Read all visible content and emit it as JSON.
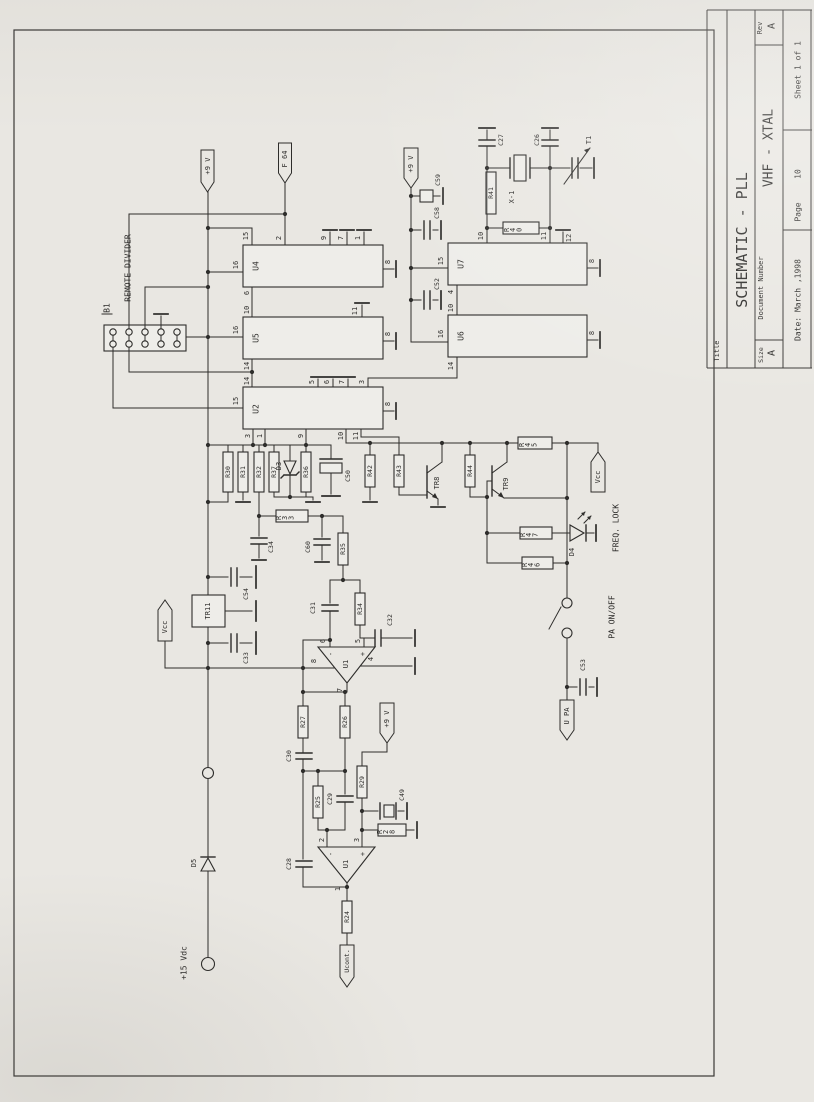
{
  "title_block": {
    "title_label": "Title",
    "title": "SCHEMATIC - PLL",
    "size_label": "Size",
    "size": "A",
    "document_number_label": "Document Number",
    "document_number": "VHF - XTAL",
    "rev_label": "Rev",
    "rev": "A",
    "date": "Date: March ,1998",
    "page_label": "Page",
    "page": "10",
    "sheet": "Sheet 1 of 1"
  },
  "annotations": {
    "b1": "B1",
    "remote_divider": "REMOTE DIVIDER",
    "pa_on_off": "PA ON/OFF",
    "freq_lock": "FREQ. LOCK",
    "plus15": "+15 Vdc"
  },
  "flags": {
    "v9_top": "+9 V",
    "v9_right": "+9 V",
    "v9_mid": "+9 V",
    "f64": "F 64",
    "vcc_left": "Vcc",
    "vcc_right": "Vcc",
    "u_pa": "U PA",
    "u_cont": "Ucont."
  },
  "components": {
    "u2": "U2",
    "u4": "U4",
    "u5": "U5",
    "u6": "U6",
    "u7": "U7",
    "op1": "U1",
    "op2": "U1",
    "tr8": "TR8",
    "tr9": "TR9",
    "tr11": "TR11",
    "x1": "X-1",
    "t1": "T1",
    "d3": "D3",
    "d4": "D4",
    "d5": "D5",
    "r24": "R24",
    "r25": "R25",
    "r26": "R26",
    "r27": "R27",
    "r28": "R28",
    "r29": "R29",
    "r30": "R30",
    "r31": "R31",
    "r32": "R32",
    "r33": "R33",
    "r34": "R34",
    "r35": "R35",
    "r36": "R36",
    "r37": "R37",
    "r40": "R40",
    "r41": "R41",
    "r42": "R42",
    "r43": "R43",
    "r44": "R44",
    "r45": "R45",
    "r46": "R46",
    "r47": "R47",
    "c26": "C26",
    "c27": "C27",
    "c28": "C28",
    "c29": "C29",
    "c30": "C30",
    "c31": "C31",
    "c32": "C32",
    "c33": "C33",
    "c34": "C34",
    "c49": "C49",
    "c50": "C50",
    "c52": "C52",
    "c53": "C53",
    "c54": "C54",
    "c58": "C58",
    "c59": "C59",
    "c60": "C60"
  },
  "pins": {
    "u4_15": "15",
    "u4_2": "2",
    "u4_9": "9",
    "u4_7": "7",
    "u4_1": "1",
    "u4_16": "16",
    "u4_6": "6",
    "u4_8": "8",
    "u5_10": "10",
    "u5_16": "16",
    "u5_11": "11",
    "u5_14": "14",
    "u5_8": "8",
    "u2_14": "14",
    "u2_15": "15",
    "u2_5": "5",
    "u2_6": "6",
    "u2_7": "7",
    "u2_3t": "3",
    "u2_3": "3",
    "u2_1": "1",
    "u2_9": "9",
    "u2_10": "10",
    "u2_11": "11",
    "u2_8": "8",
    "u7_15": "15",
    "u7_10": "10",
    "u7_11": "11",
    "u7_12": "12",
    "u7_4": "4",
    "u7_8": "8",
    "u6_10": "10",
    "u6_16": "16",
    "u6_14": "14",
    "u6_8": "8",
    "op1_6": "6",
    "op1_5": "5",
    "op1_8": "8",
    "op1_4": "4",
    "op1_7": "7",
    "op1_minus": "-",
    "op1_plus": "+",
    "op2_2": "2",
    "op2_3": "3",
    "op2_1": "1",
    "op2_minus": "-",
    "op2_plus": "+"
  }
}
